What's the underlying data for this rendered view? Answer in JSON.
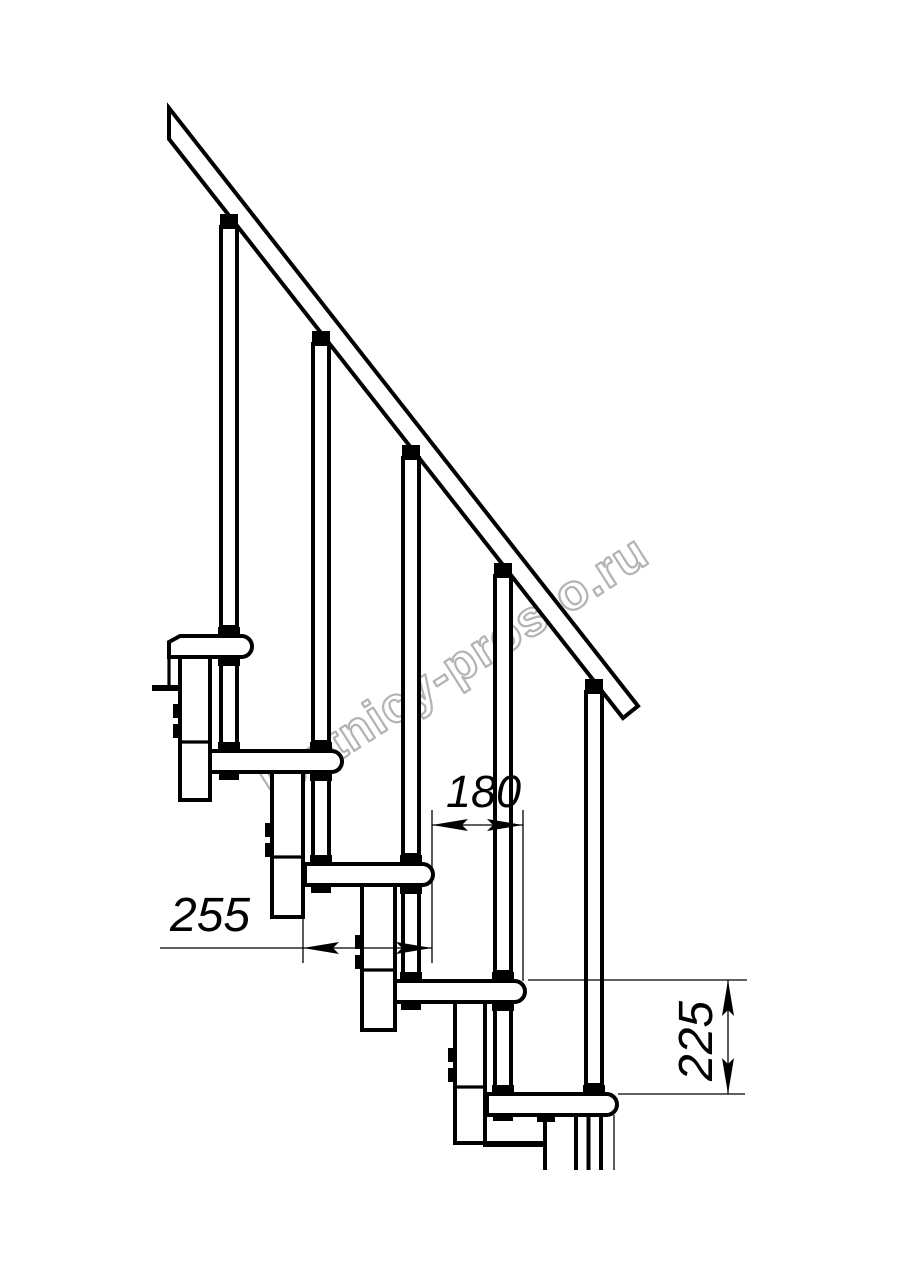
{
  "drawing": {
    "dimensions": {
      "step_run_mm": "180",
      "tread_depth_mm": "255",
      "step_rise_mm": "225"
    },
    "watermark": "lestnicy-prosto.ru",
    "colors": {
      "line": "#000000",
      "watermark_gray": "#b3b3b3",
      "background": "#ffffff"
    }
  }
}
